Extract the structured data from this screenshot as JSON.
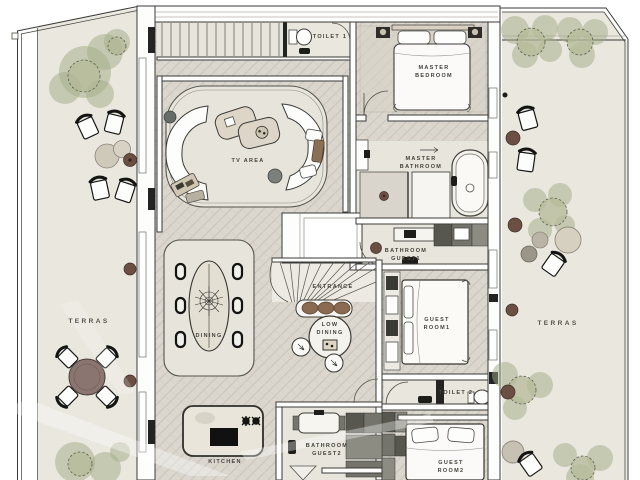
{
  "labels": {
    "toilet1": "TOILET 1",
    "master_bedroom": "MASTER\nBEDROOM",
    "tv_area": "TV AREA",
    "master_bathroom": "MASTER\nBATHROOM",
    "bathroom_guest1": "BATHROOM\nGUEST1",
    "entrance": "ENTRANCE",
    "low_dining": "LOW\nDINING",
    "guest_room1": "GUEST\nROOM1",
    "dining": "DINING",
    "terras_left": "TERRAS",
    "terras_right": "TERRAS",
    "toilet2": "TOILET 2",
    "kitchen": "KITCHEN",
    "bathroom_guest2": "BATHROOM\nGUEST2",
    "guest_room2": "GUEST\nROOM2"
  },
  "colors": {
    "line": "#3a3a38",
    "housefloor": "#dbd7cf",
    "terrace": "#eae7de",
    "bathfloor": "#e8e5dc",
    "foliage": "#a2ab85",
    "brown": "#6b4f43",
    "mauve": "#8b7571",
    "labeltext": "#43423b"
  }
}
